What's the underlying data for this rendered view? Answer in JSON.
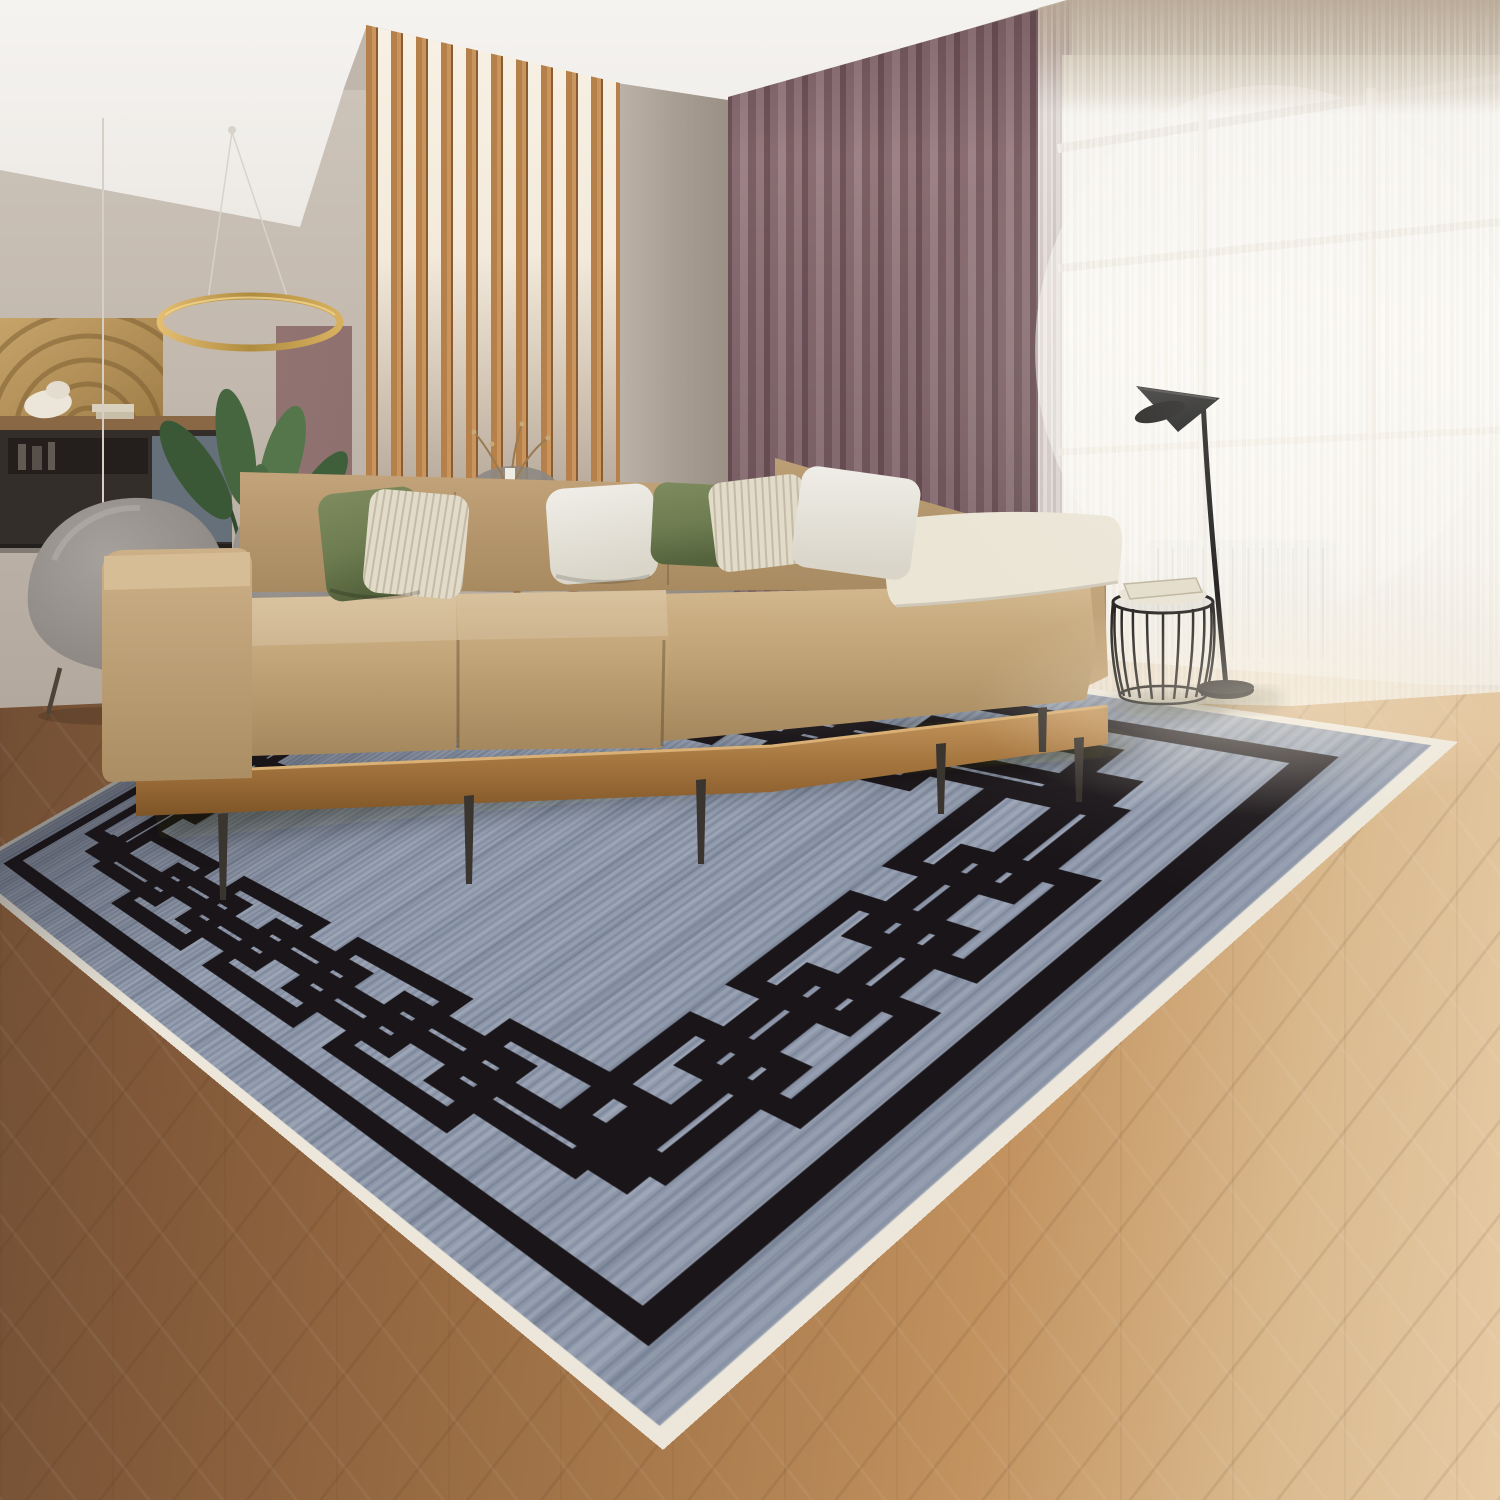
{
  "meta": {
    "image_type": "interior-lifestyle-product-photo",
    "subject": "large area rug with black interlocking greek-key chain border on heathered blue-gray field, staged in a modern living room"
  },
  "colors": {
    "--ceiling": "#f2efeb",
    "--wall": "#b5aba1",
    "--wall-dining": "#c6bdb3",
    "--slat-wood": "#b5804a",
    "--curtain-mauve": "#8f7277",
    "--sheer-white": "#f3f0ea",
    "--sofa-beige": "#c6a87d",
    "--sofa-top": "#d6bb92",
    "--wood-base": "#b08050",
    "--pillow-green": "#6e7d51",
    "--pillow-cream": "#e2dbc9",
    "--pillow-white": "#ebe9e3",
    "--floor-dark": "#6b4a31",
    "--floor-light": "#d9b88c",
    "--rug-field": "#8c96a8",
    "--rug-black": "#1a1518",
    "--rug-binding": "#ece7da",
    "--lamp-black": "#141414",
    "--chair-gray": "#8d8883",
    "--table-white": "#e9e7e1",
    "--ring-gold": "#c9a254",
    "--plant-green": "#4a6a45"
  },
  "scene": {
    "objects": [
      "area-rug-greek-key-border",
      "l-shaped-beige-sectional-sofa",
      "throw-pillows-green-cream-white",
      "wood-platform-sofa-base",
      "aj-style-black-floor-lamp",
      "wire-cage-stool-side-table",
      "round-dining-table",
      "gray-shell-dining-chairs",
      "gold-ring-chandelier",
      "textured-wall-art-panel",
      "dark-console-shelf",
      "bird-of-paradise-plant",
      "wood-slat-room-divider",
      "mauve-blackout-curtains",
      "white-sheer-curtains",
      "large-window",
      "radiator",
      "herringbone-wood-floor"
    ]
  }
}
